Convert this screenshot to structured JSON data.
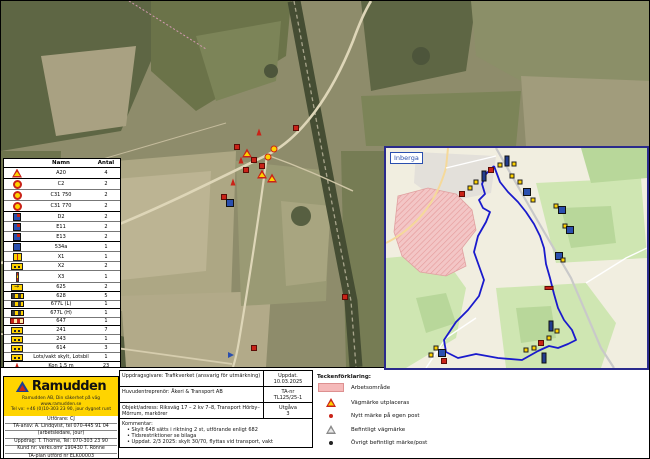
{
  "colors": {
    "brand_yellow": "#ffd400",
    "route_blue": "#1a1acc",
    "work_pink": "#f5b9b9",
    "sign_red": "#c92318",
    "sign_yellow": "#ffd200",
    "sign_blue": "#2a4fae"
  },
  "sign_table": {
    "headers": {
      "icon": "",
      "name": "Namn",
      "count": "Antal"
    },
    "rows": [
      {
        "icon": "tri",
        "name": "A20",
        "count": "4",
        "grp": false
      },
      {
        "icon": "cred",
        "name": "C2",
        "count": "2",
        "grp": true
      },
      {
        "icon": "cspeed",
        "name": "C31 750",
        "count": "2",
        "grp": false
      },
      {
        "icon": "cspeed",
        "name": "C31 770",
        "count": "2",
        "grp": false
      },
      {
        "icon": "sqbluemix",
        "name": "D2",
        "count": "2",
        "grp": true
      },
      {
        "icon": "sqbluemix",
        "name": "E11",
        "count": "2",
        "grp": false
      },
      {
        "icon": "sqbluemix",
        "name": "E13",
        "count": "2",
        "grp": false
      },
      {
        "icon": "sqblue",
        "name": "534a",
        "count": "1",
        "grp": true
      },
      {
        "icon": "rectsplit",
        "name": "X1",
        "count": "1",
        "grp": false
      },
      {
        "icon": "recty",
        "name": "X2",
        "count": "2",
        "grp": false
      },
      {
        "icon": "pole",
        "name": "X3",
        "count": "1",
        "grp": false
      },
      {
        "icon": "arrow",
        "name": "625",
        "count": "2",
        "grp": false
      },
      {
        "icon": "bardark",
        "name": "628",
        "count": "5",
        "grp": true
      },
      {
        "icon": "bardark",
        "name": "677L (L)",
        "count": "1",
        "grp": false
      },
      {
        "icon": "bardark",
        "name": "677L (H)",
        "count": "1",
        "grp": true
      },
      {
        "icon": "barstripe",
        "name": "647",
        "count": "1",
        "grp": false
      },
      {
        "icon": "recty",
        "name": "241",
        "count": "7",
        "grp": true
      },
      {
        "icon": "recty",
        "name": "243",
        "count": "1",
        "grp": false
      },
      {
        "icon": "recty",
        "name": "614",
        "count": "3",
        "grp": false
      },
      {
        "icon": "recty",
        "name": "Lots/vakt skylt, Lotsbil",
        "count": "1",
        "grp": false
      },
      {
        "icon": "cone",
        "name": "Kon 1,5 m",
        "count": "23",
        "grp": true
      },
      {
        "icon": "flag",
        "name": "Markör",
        "count": "1",
        "grp": false
      },
      {
        "icon": "person",
        "name": "Personal, vakt",
        "count": "3",
        "grp": false
      }
    ]
  },
  "inset": {
    "label": "Inberga",
    "route_points": "108,18 100,26 96,36 99,46 93,52 97,60 104,64 100,74 92,88 88,104 93,118 98,132 93,148 82,162 70,174 58,192 60,204 72,210 90,206 112,210 136,212 152,203 163,198 172,200 182,196 190,192 186,182 178,172 172,160 168,146 164,130 160,116 158,100 154,88 148,76 140,64 132,54 122,44 114,34 108,18",
    "markers": [
      {
        "x": 114,
        "y": 17,
        "t": "sy"
      },
      {
        "x": 121,
        "y": 13,
        "t": "navy"
      },
      {
        "x": 128,
        "y": 16,
        "t": "sy"
      },
      {
        "x": 105,
        "y": 22,
        "t": "sqred"
      },
      {
        "x": 98,
        "y": 28,
        "t": "navy"
      },
      {
        "x": 90,
        "y": 34,
        "t": "sy"
      },
      {
        "x": 84,
        "y": 40,
        "t": "sy"
      },
      {
        "x": 76,
        "y": 46,
        "t": "sqred"
      },
      {
        "x": 126,
        "y": 28,
        "t": "sy"
      },
      {
        "x": 134,
        "y": 34,
        "t": "sy"
      },
      {
        "x": 141,
        "y": 44,
        "t": "sqblue"
      },
      {
        "x": 147,
        "y": 52,
        "t": "sy"
      },
      {
        "x": 170,
        "y": 58,
        "t": "sy"
      },
      {
        "x": 176,
        "y": 62,
        "t": "sqblue"
      },
      {
        "x": 179,
        "y": 78,
        "t": "sy"
      },
      {
        "x": 184,
        "y": 82,
        "t": "sqblue"
      },
      {
        "x": 173,
        "y": 108,
        "t": "sqblue"
      },
      {
        "x": 177,
        "y": 112,
        "t": "sy"
      },
      {
        "x": 163,
        "y": 140,
        "t": "srwide"
      },
      {
        "x": 165,
        "y": 178,
        "t": "navy"
      },
      {
        "x": 171,
        "y": 183,
        "t": "sy"
      },
      {
        "x": 163,
        "y": 190,
        "t": "sy"
      },
      {
        "x": 155,
        "y": 195,
        "t": "sqred"
      },
      {
        "x": 158,
        "y": 210,
        "t": "navy"
      },
      {
        "x": 148,
        "y": 200,
        "t": "sy"
      },
      {
        "x": 140,
        "y": 202,
        "t": "sy"
      },
      {
        "x": 50,
        "y": 200,
        "t": "sy"
      },
      {
        "x": 56,
        "y": 205,
        "t": "sqblue"
      },
      {
        "x": 45,
        "y": 207,
        "t": "sy"
      },
      {
        "x": 58,
        "y": 213,
        "t": "sqred"
      }
    ]
  },
  "main_map": {
    "markers": [
      {
        "x": 295,
        "y": 127,
        "t": "sqred"
      },
      {
        "x": 258,
        "y": 131,
        "t": "cone"
      },
      {
        "x": 236,
        "y": 146,
        "t": "sqred"
      },
      {
        "x": 246,
        "y": 152,
        "t": "tri"
      },
      {
        "x": 253,
        "y": 159,
        "t": "sqred"
      },
      {
        "x": 261,
        "y": 165,
        "t": "sqred"
      },
      {
        "x": 267,
        "y": 156,
        "t": "cy"
      },
      {
        "x": 273,
        "y": 148,
        "t": "cy"
      },
      {
        "x": 261,
        "y": 173,
        "t": "tri"
      },
      {
        "x": 271,
        "y": 177,
        "t": "tri"
      },
      {
        "x": 245,
        "y": 169,
        "t": "sqred"
      },
      {
        "x": 240,
        "y": 159,
        "t": "cone"
      },
      {
        "x": 232,
        "y": 181,
        "t": "cone"
      },
      {
        "x": 223,
        "y": 196,
        "t": "sqred"
      },
      {
        "x": 229,
        "y": 202,
        "t": "sqblue"
      },
      {
        "x": 253,
        "y": 347,
        "t": "sqred"
      },
      {
        "x": 230,
        "y": 354,
        "t": "flag"
      },
      {
        "x": 344,
        "y": 296,
        "t": "sqred"
      }
    ]
  },
  "company": {
    "brand": "Ramudden",
    "yellow_lines": [
      "Ramudden AB, Din säkerhet på väg",
      "www.ramudden.se",
      "Tel vx: +46 (0)10-303 23 90, jour dygnet runt"
    ],
    "info_lines": [
      "Utförare: CJ",
      "TA-ansv: A. Lindqvist, tel 070-445 91 04",
      "(arbetsledare, jour)",
      "Uppdrag: T. Thorne, Tel: 070-303 23 90",
      "Kund nr: verks.omr 190430 T. Rönne",
      "TA-plan utförd nr ELK00003"
    ]
  },
  "title_block": {
    "rows": [
      {
        "left": "Uppdragsgivare: Trafikverket (ansvarig för utmärkning)",
        "meta_label": "Uppdat.",
        "meta_value": "10.03.2025"
      },
      {
        "left": "Huvudentreprenör: Åkeri & Transport AB",
        "meta_label": "TA-nr",
        "meta_value": "TL125/25-1"
      },
      {
        "left": "Objekt/adress: Riksväg 17 – 2 kv 7–8, Transport Hörby–Mörrum, markörer",
        "meta_label": "Utgåva",
        "meta_value": "3"
      }
    ],
    "comment_label": "Kommentar:",
    "comment_lines": [
      "Skylt 648 sätts i riktning 2 st, utförande enligt 682",
      "Tidsrestriktioner se bilaga",
      "Uppdat. 2/3 2025: skylt 30/70, flyttas vid transport, vakt"
    ]
  },
  "legend_right": {
    "title": "Teckenförklaring:",
    "items": [
      {
        "icon": "swatchpink",
        "label": "Arbetsområde"
      },
      {
        "icon": "tri",
        "label": "Vägmärke utplaceras"
      },
      {
        "icon": "dotred",
        "label": "Nytt märke på egen post"
      },
      {
        "icon": "trigray",
        "label": "Befintligt vägmärke"
      },
      {
        "icon": "dotblack",
        "label": "Övrigt befintligt märke/post"
      }
    ]
  }
}
